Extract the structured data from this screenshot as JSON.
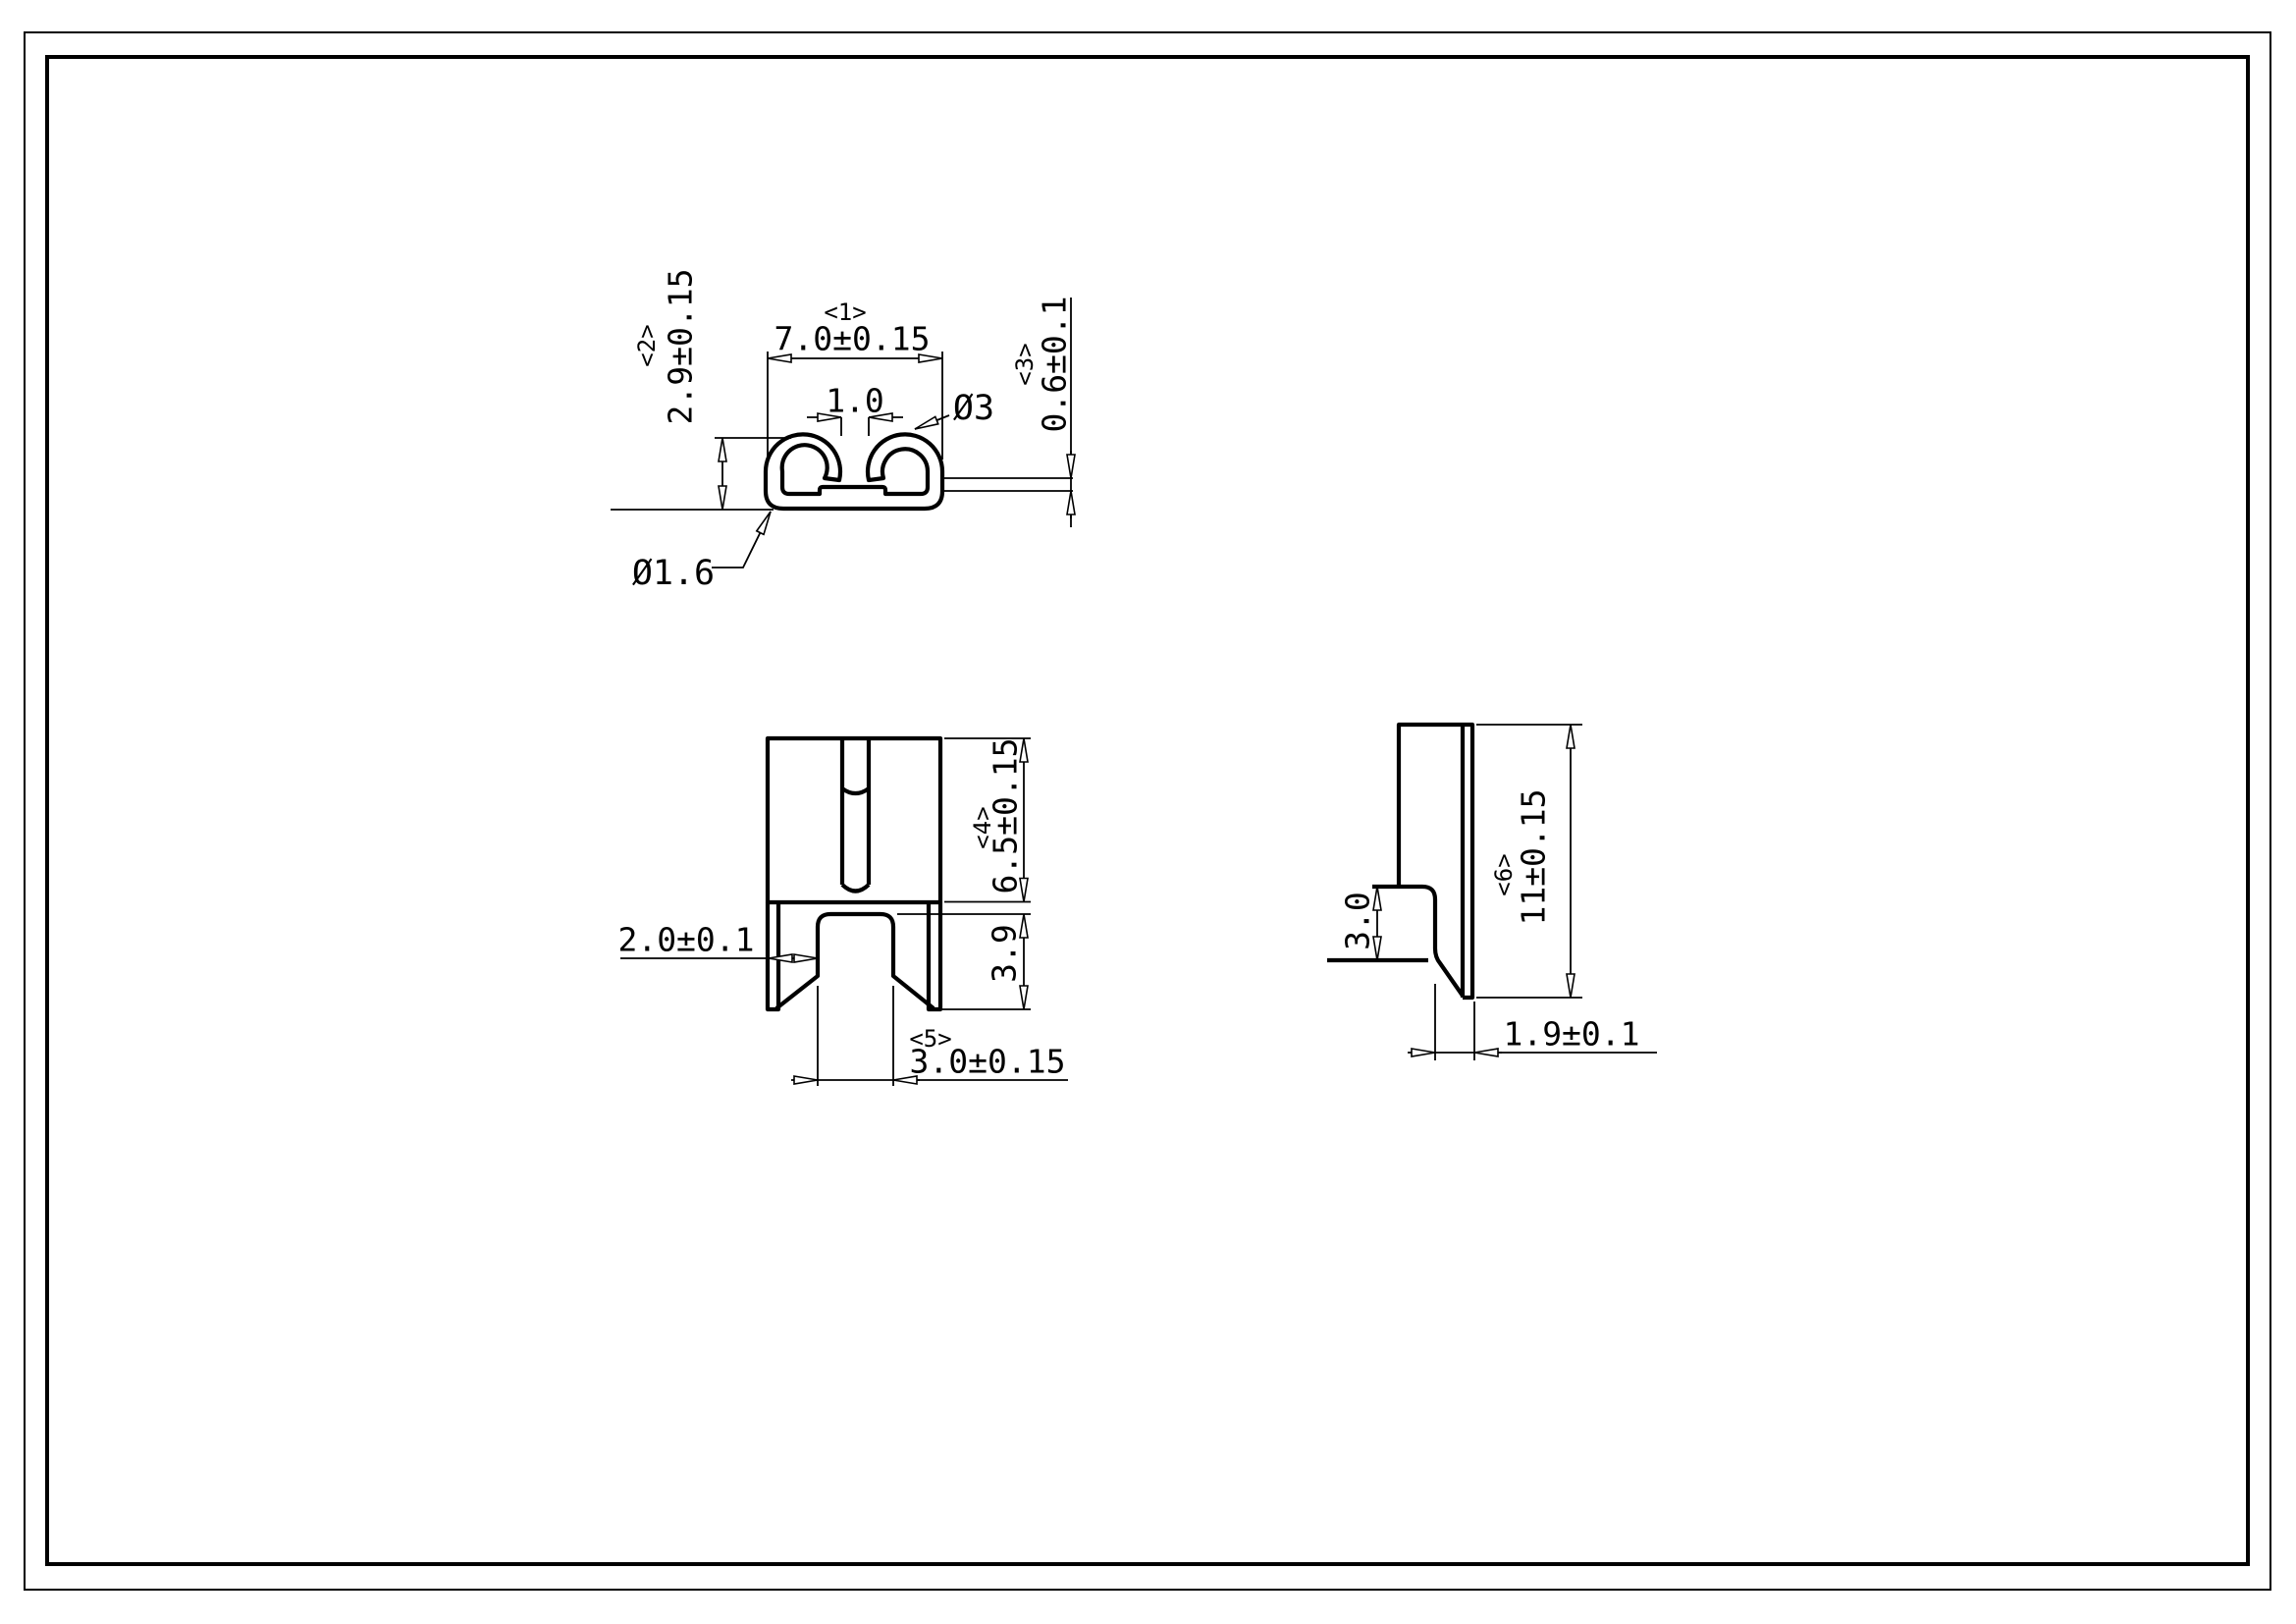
{
  "drawing_background": "#ffffff",
  "line_color": "#000000",
  "top_view": {
    "index_width": "<1>",
    "width": "7.0±0.15",
    "index_depth": "<2>",
    "depth": "2.9±0.15",
    "index_thickness": "<3>",
    "thickness": "0.6±0.1",
    "hook_gap": "1.0",
    "hook_diameter": "Ø3",
    "corner_diameter": "Ø1.6"
  },
  "front_view": {
    "index_body_height": "<4>",
    "body_height": "6.5±0.15",
    "leg_height": "3.9",
    "index_tab_width": "<5>",
    "tab_width": "3.0±0.15",
    "leg_to_tab_gap": "2.0±0.1"
  },
  "side_view": {
    "index_total_height": "<6>",
    "total_height": "11±0.15",
    "step_height": "3.0",
    "tab_offset": "1.9±0.1"
  }
}
